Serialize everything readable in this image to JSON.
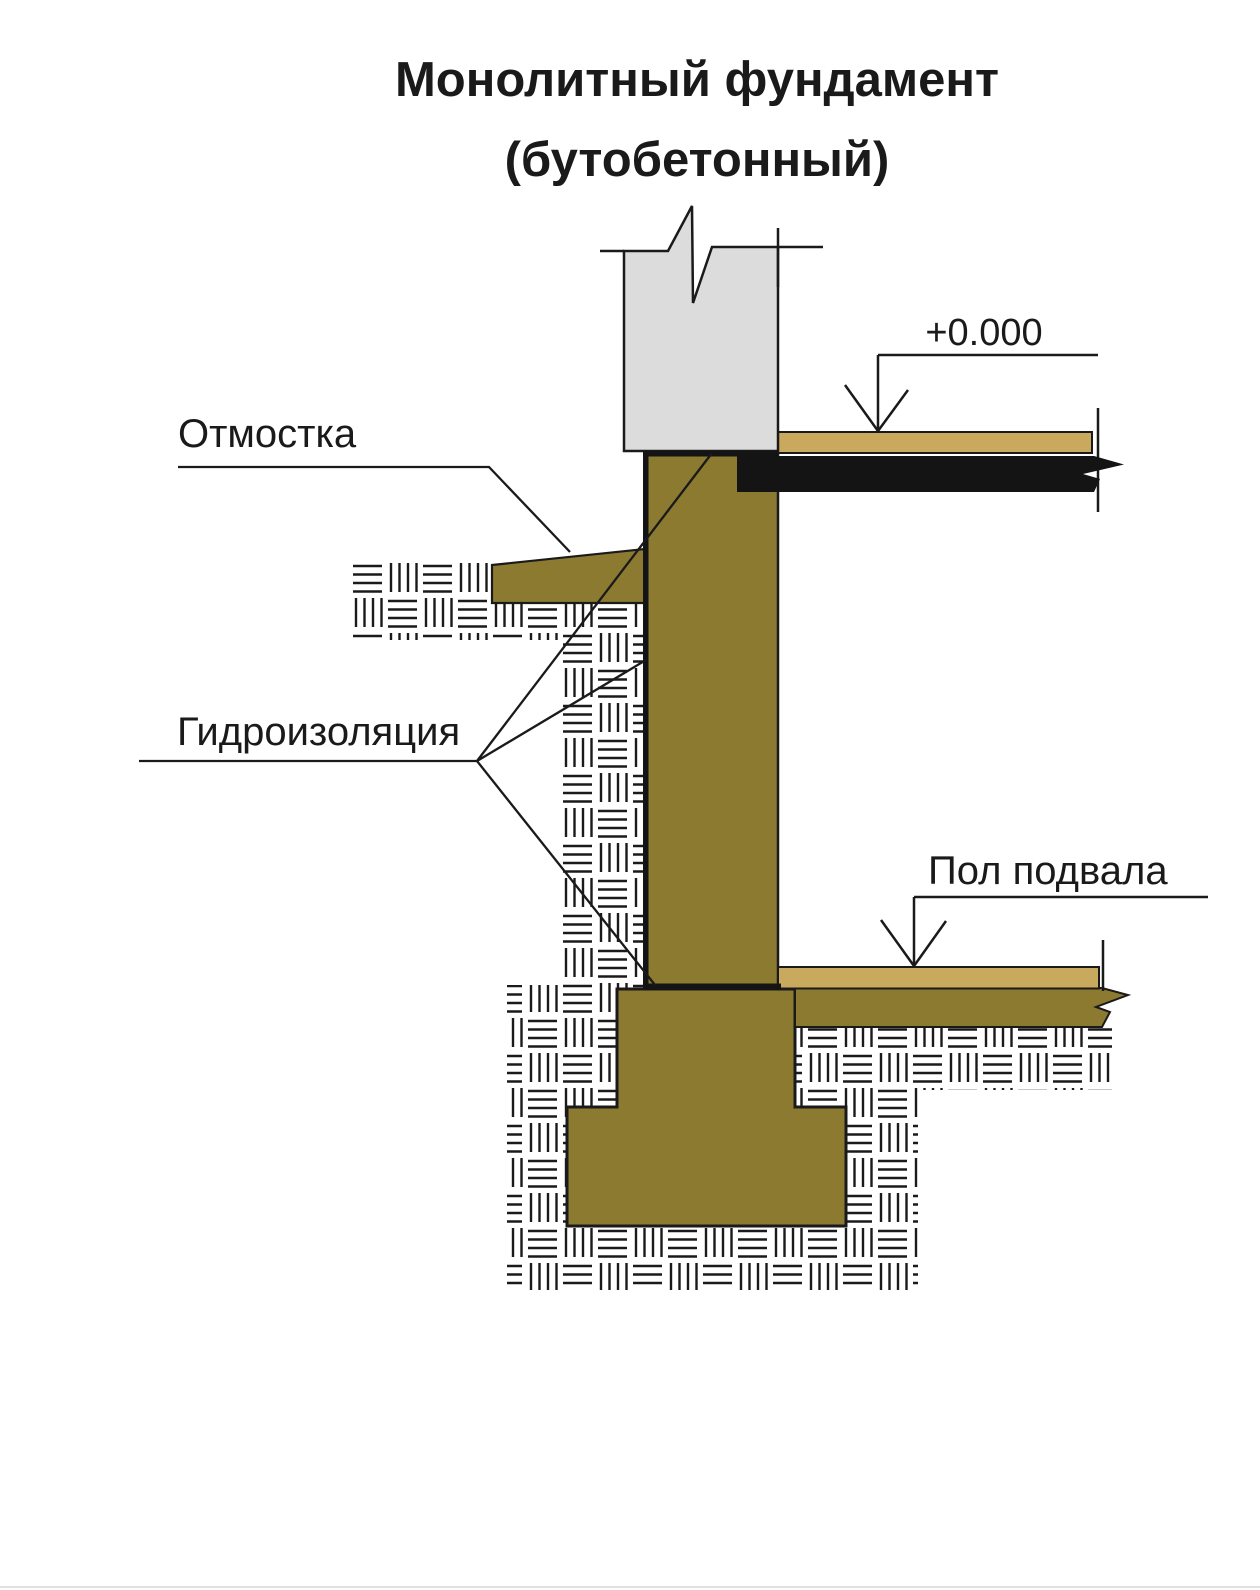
{
  "title": {
    "line1": "Монолитный фундамент",
    "line2": "(бутобетонный)"
  },
  "labels": {
    "blind_area": "Отмостка",
    "waterproofing": "Гидроизоляция",
    "basement_floor": "Пол подвала",
    "elevation_mark": "+0.000"
  },
  "colors": {
    "concrete": "#8d7a31",
    "floor_screed": "#c9a95e",
    "wall_above": "#dcdcdc",
    "waterproofing_black": "#141414",
    "line": "#1a1a1a",
    "background": "#ffffff"
  }
}
